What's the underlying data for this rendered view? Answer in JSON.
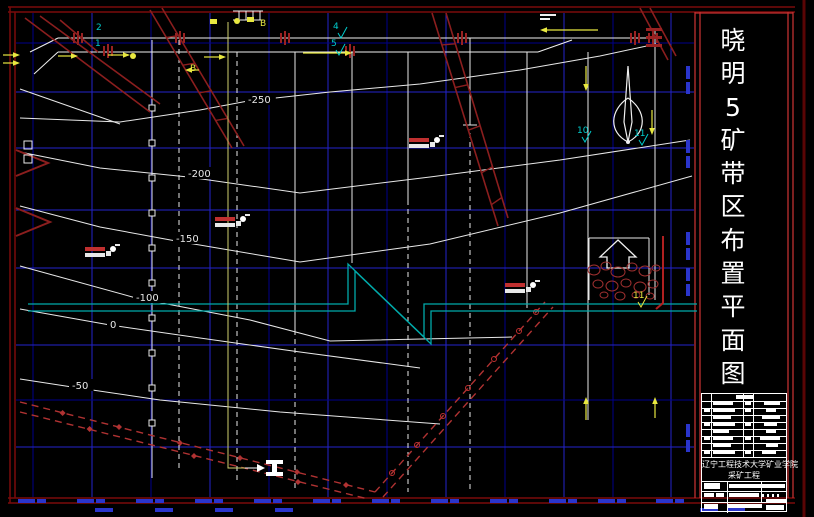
{
  "title_panel": {
    "text": "晓明5矿带区布置平面图"
  },
  "title_block": {
    "school": "辽宁工程技术大学矿业学院",
    "department": "采矿工程",
    "small_text_legible": false
  },
  "drawing": {
    "contour_labels": [
      {
        "text": "-250",
        "x": 248,
        "y": 103
      },
      {
        "text": "-200",
        "x": 188,
        "y": 177
      },
      {
        "text": "-150",
        "x": 176,
        "y": 242
      },
      {
        "text": "-100",
        "x": 136,
        "y": 301
      },
      {
        "text": "0",
        "x": 110,
        "y": 328
      },
      {
        "text": "-50",
        "x": 72,
        "y": 389
      }
    ],
    "point_labels": [
      {
        "text": "2",
        "x": 96,
        "y": 30,
        "color": "#00CCCC",
        "tick": false
      },
      {
        "text": "1",
        "x": 95,
        "y": 46,
        "color": "#00CCCC",
        "tick": false
      },
      {
        "text": "4",
        "x": 333,
        "y": 29,
        "color": "#00CCCC",
        "tick": true
      },
      {
        "text": "5",
        "x": 331,
        "y": 46,
        "color": "#00CCCC",
        "tick": true
      },
      {
        "text": "10",
        "x": 577,
        "y": 133,
        "color": "#00CCCC",
        "tick": true
      },
      {
        "text": "11",
        "x": 634,
        "y": 136,
        "color": "#00CCCC",
        "tick": true
      },
      {
        "text": "11",
        "x": 633,
        "y": 298,
        "color": "#E8E840",
        "tick": true
      },
      {
        "text": "B",
        "x": 260,
        "y": 26,
        "color": "#E8E840",
        "tick": false
      },
      {
        "text": "B",
        "x": 190,
        "y": 71,
        "color": "#E8E840",
        "tick": false
      }
    ],
    "borehole_markers": [
      {
        "x": 425,
        "y": 143,
        "legible": false
      },
      {
        "x": 231,
        "y": 222,
        "legible": false
      },
      {
        "x": 101,
        "y": 252,
        "legible": false
      },
      {
        "x": 521,
        "y": 288,
        "legible": false
      }
    ],
    "coordinate_marks": {
      "legible": false,
      "bottom_labels_x": [
        33,
        92,
        151,
        210,
        269,
        328,
        387,
        446,
        505,
        564,
        613,
        671
      ],
      "right_labels_y": [
        66,
        140,
        232,
        268,
        424
      ],
      "bottom_dashes_x": [
        95,
        155,
        215,
        275,
        700,
        727
      ]
    },
    "colors": {
      "background": "#000000",
      "grid_bright": "#2323CC",
      "grid_dim": "#00008B",
      "contour": "#E8E8E8",
      "fault": "#8B1E1E",
      "boundary": "#B03232",
      "conveyor": "#00AAAA",
      "frame": "#7A0A0A",
      "panel_frame": "#C03030",
      "coordinate_text": "#2A35CC",
      "highlight": "#E8E840"
    }
  }
}
